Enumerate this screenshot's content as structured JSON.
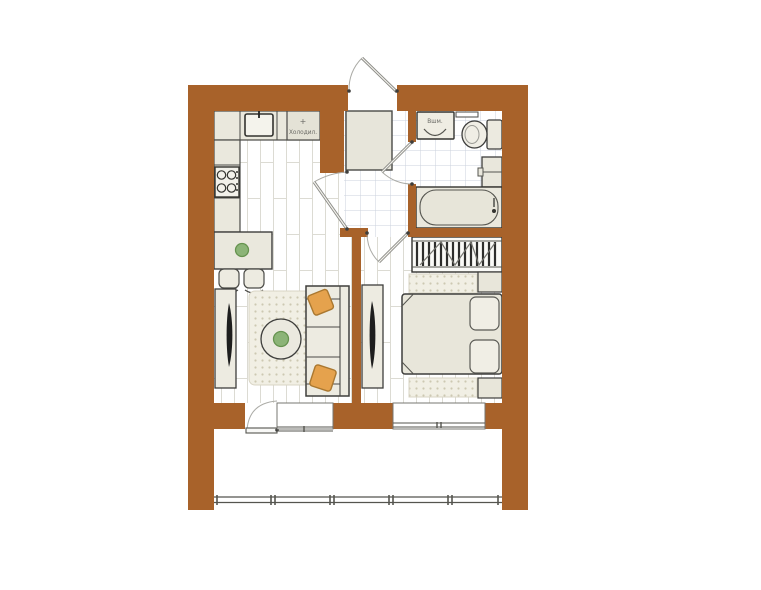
{
  "plan": {
    "labels": {
      "fridge_symbol": "+",
      "fridge": "Холодил.",
      "washer": "Вшм."
    },
    "colors": {
      "wall": "#A8622A",
      "furniture_fill": "#EAE8DD",
      "furniture_stroke": "#3E3E3C",
      "plant_green": "#8CB477",
      "pillow_orange": "#E5A24D",
      "tv_black": "#1E1E1E",
      "plank_line": "#DCDBD3",
      "tile_line": "#CBD2DC",
      "rug_fill": "#F1EFE4",
      "rug_dot": "#CDC8B2",
      "background": "#FFFFFF"
    }
  }
}
